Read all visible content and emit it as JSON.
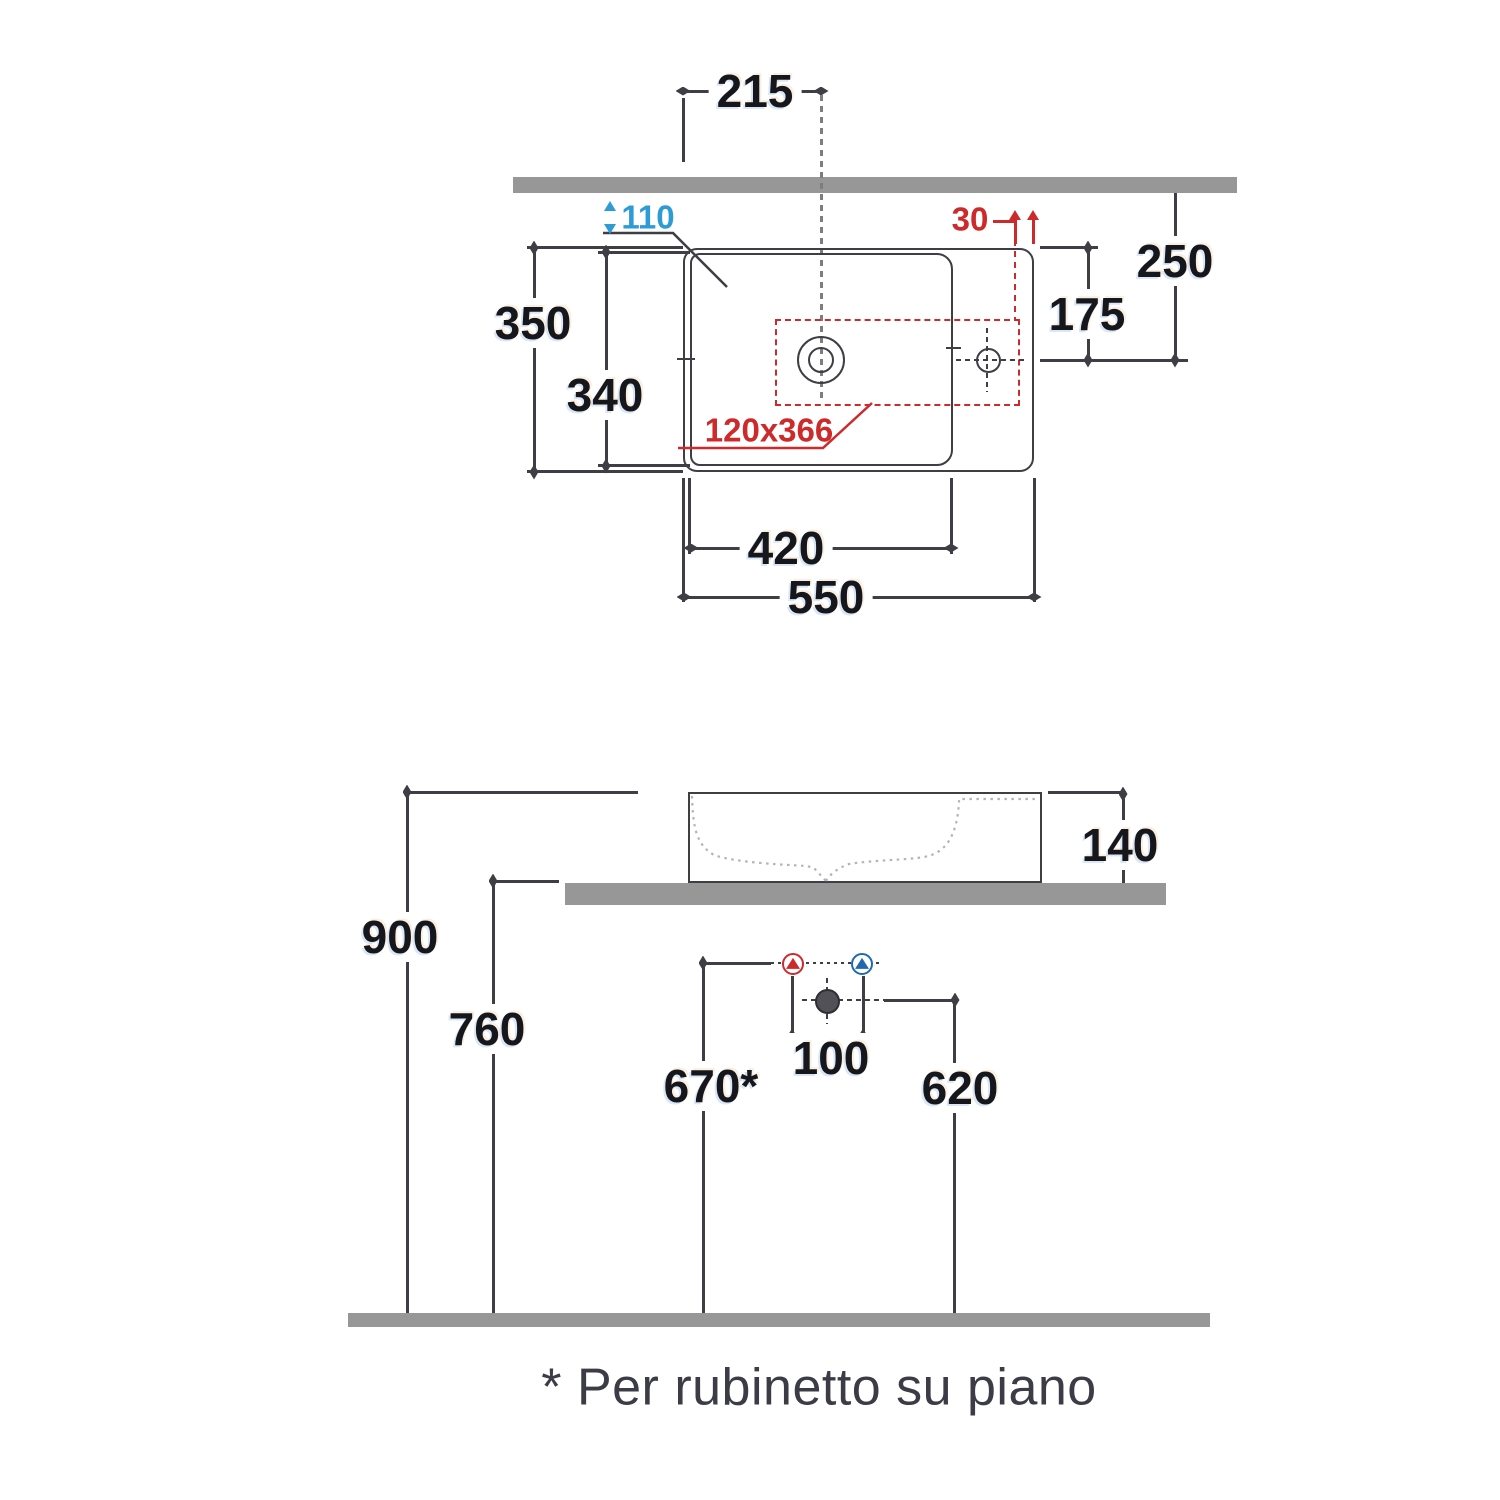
{
  "colors": {
    "line": "#3e3e44",
    "text": "#16161d",
    "bar": "#979797",
    "red": "#cd2a2c",
    "blue": "#2e9bd6",
    "cold": "#2069b1",
    "profile": "#b4b4b4",
    "drainfill": "#515157",
    "footnote_color": "#3c3c46"
  },
  "top_view": {
    "dims": {
      "drain_offset": "215",
      "rim_depth": "110",
      "tap_edge_gap": "30",
      "tap_to_wall": "250",
      "tap_to_front": "175",
      "overall_depth": "350",
      "basin_depth": "340",
      "cutout_size": "120x366",
      "basin_width": "420",
      "overall_width": "550"
    }
  },
  "front_view": {
    "dims": {
      "basin_height": "140",
      "rim_height": "900",
      "counter_height": "760",
      "supply_height": "670*",
      "supply_spacing": "100",
      "drain_height": "620"
    }
  },
  "footnote": "* Per rubinetto su piano"
}
